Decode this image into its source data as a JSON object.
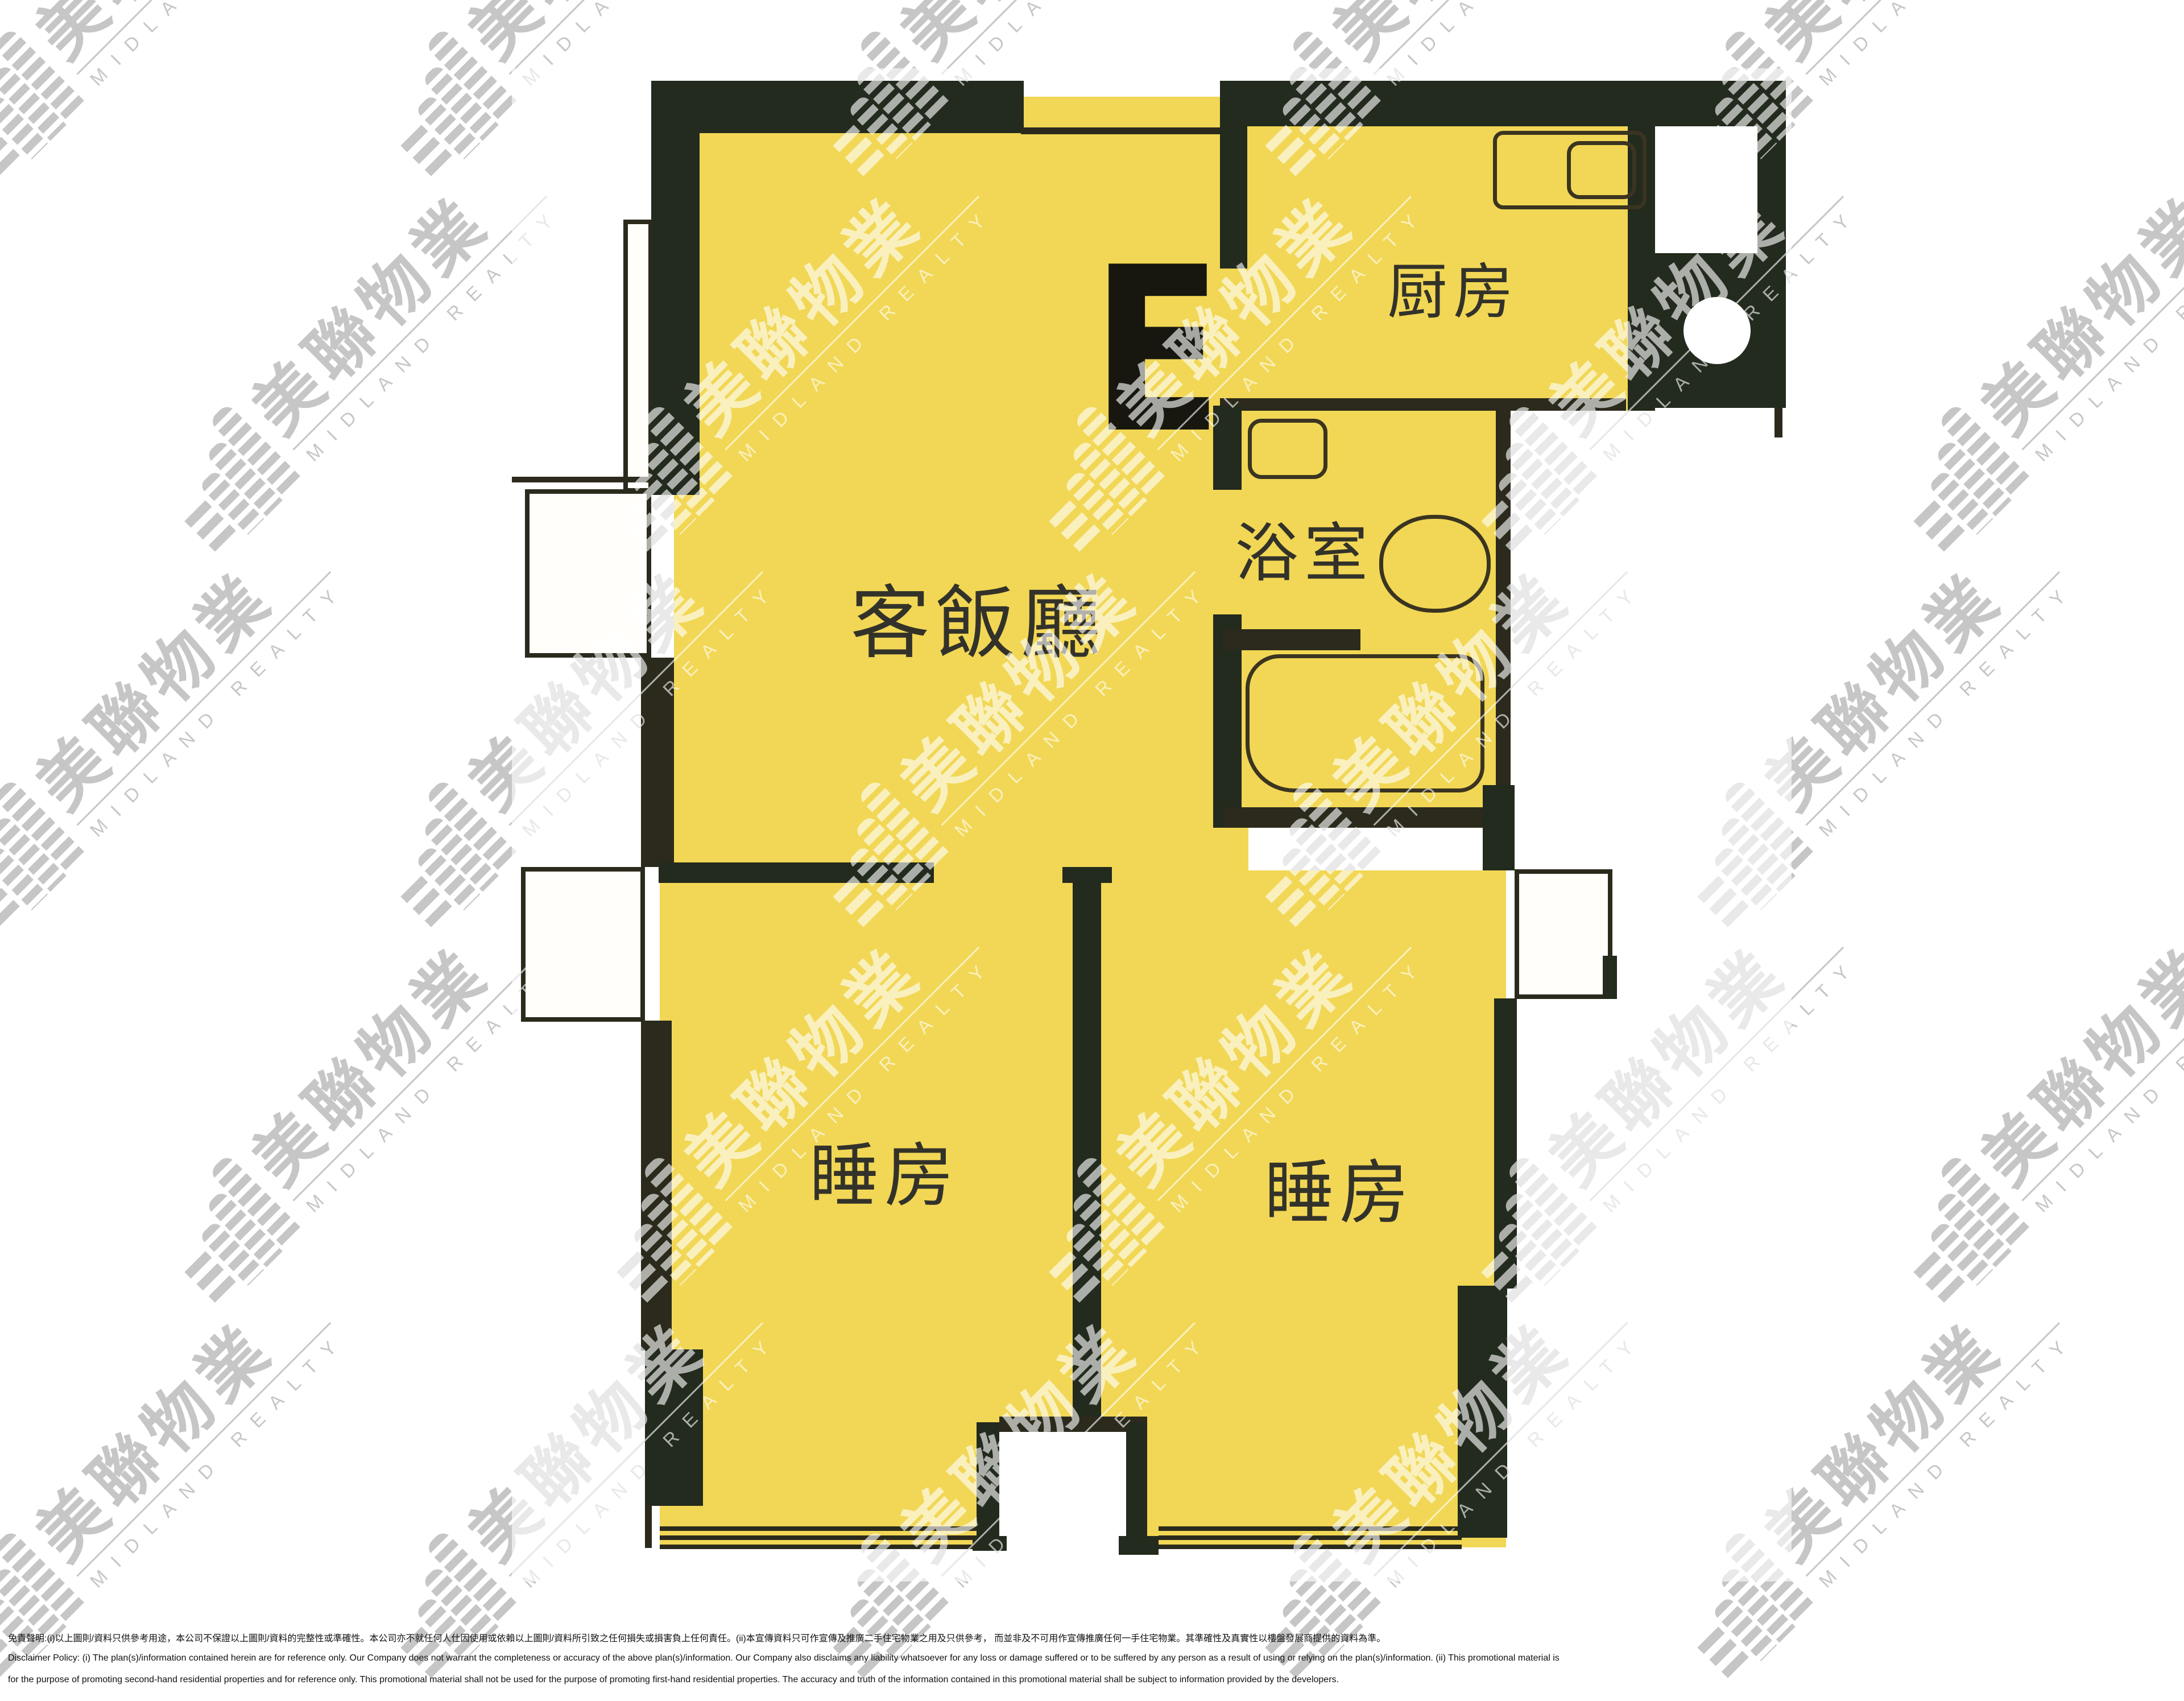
{
  "plan": {
    "unit_label": "E",
    "rooms": {
      "living_dining": "客飯廳",
      "kitchen": "厨房",
      "bathroom": "浴室",
      "bedroom_left": "睡房",
      "bedroom_right": "睡房"
    }
  },
  "watermark": {
    "cn": "美聯物業",
    "en": "MIDLAND REALTY"
  },
  "disclaimer": {
    "line1_zh": "免責聲明:(i)以上圖則/資料只供參考用途，本公司不保證以上圖則/資料的完整性或準確性。本公司亦不就任何人仕因使用或依賴以上圖則/資料所引致之任何損失或損害負上任何責任。(ii)本宣傳資料只可作宣傳及推廣二手住宅物業之用及只供參考， 而並非及不可用作宣傳推廣任何一手住宅物業。其準確性及真實性以樓盤發展商提供的資料為準。",
    "line2_en": "Disclaimer Policy: (i) The plan(s)/information contained herein are for reference only. Our Company does not warrant the completeness or accuracy of the above plan(s)/information. Our Company also disclaims any liability whatsoever for any loss or damage suffered or to be suffered by any person as a result of using or relying on the plan(s)/information. (ii) This promotional material is",
    "line3_en": "for the purpose of promoting second-hand residential properties and for reference only. This promotional material shall not be used for the purpose of promoting first-hand residential properties. The accuracy and truth of the information contained in this promotional material shall be subject to information provided by the developers."
  },
  "colors": {
    "room_fill": "#F1D755",
    "wall": "#232A1E",
    "wall_thin": "#2B2A1C",
    "fixture": "#3A3420",
    "wm_gray": "#C6C6C6",
    "wm_over": "rgba(255,255,255,0.62)",
    "label": "#33322A"
  }
}
